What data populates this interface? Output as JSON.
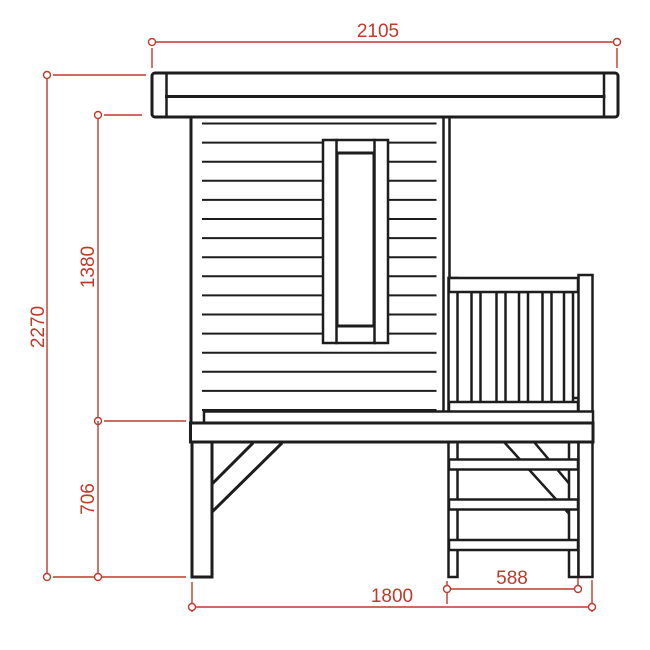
{
  "figure": {
    "kind": "technical-elevation-drawing",
    "subject": "stilted playhouse side elevation with porch railing and ladder",
    "background_color": "#ffffff",
    "outline_color": "#1d1d1d",
    "dimension_color": "#c0392b"
  },
  "parts": [
    {
      "name": "flat-roof"
    },
    {
      "name": "clapboard-wall"
    },
    {
      "name": "tall-window"
    },
    {
      "name": "porch-railing"
    },
    {
      "name": "deck-floor"
    },
    {
      "name": "support-leg"
    },
    {
      "name": "diagonal-brace"
    },
    {
      "name": "ladder"
    }
  ],
  "dimensions": [
    {
      "id": "roof-width",
      "label": "2105",
      "orientation": "horizontal",
      "position": "top"
    },
    {
      "id": "total-height",
      "label": "2270",
      "orientation": "vertical",
      "position": "far-left"
    },
    {
      "id": "cabin-height",
      "label": "1380",
      "orientation": "vertical",
      "position": "left-upper"
    },
    {
      "id": "leg-height",
      "label": "706",
      "orientation": "vertical",
      "position": "left-lower"
    },
    {
      "id": "base-width",
      "label": "1800",
      "orientation": "horizontal",
      "position": "bottom"
    },
    {
      "id": "ladder-width",
      "label": "588",
      "orientation": "horizontal",
      "position": "bottom-right"
    }
  ]
}
